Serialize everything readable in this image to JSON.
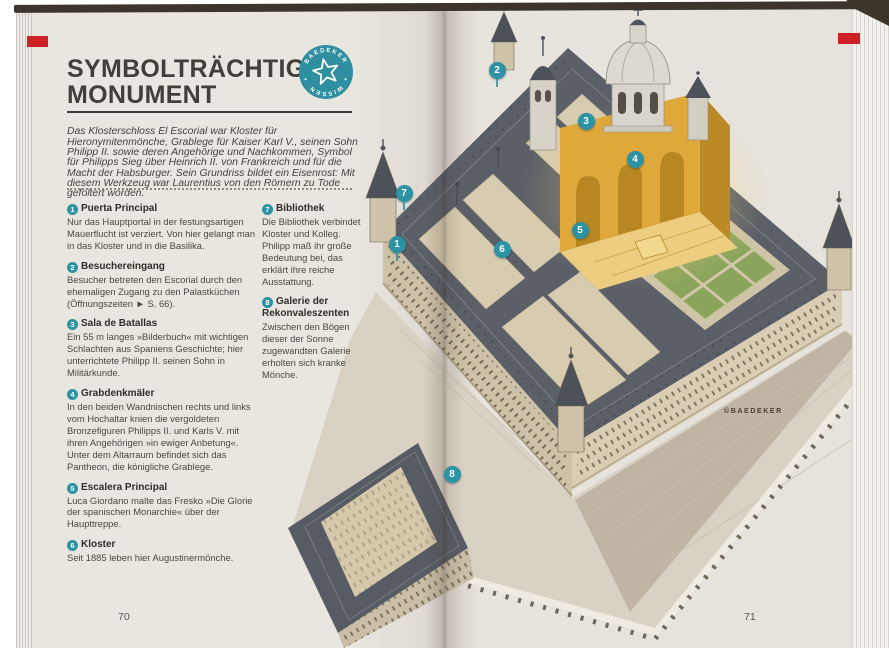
{
  "book": {
    "title_line1": "SYMBOLTRÄCHTIGES",
    "title_line2": "MONUMENT",
    "badge": {
      "top": "BAEDEKER",
      "bottom": "WISSEN",
      "color": "#2e8fa0"
    },
    "intro": "Das Klosterschloss El Escorial war Kloster für Hieronymitenmönche, Grablege für Kaiser Karl V., seinen Sohn Philipp II. sowie deren Angehörige und Nachkommen, Symbol für Philipps Sieg über Heinrich II. von Frankreich und für die Macht der Habsburger. Sein Grundriss bildet ein Eisenrost: Mit diesem Werkzeug war Laurentius von den Römern zu Tode gefoltert worden.",
    "credit": "©BAEDEKER",
    "left_page_number": "70",
    "right_page_number": "71"
  },
  "legend": {
    "items": [
      {
        "num": "1",
        "title": "Puerta Principal",
        "text": "Nur das Hauptportal in der festungsartigen Mauerflucht ist verziert. Von hier gelangt man in das Kloster und in die Basilika."
      },
      {
        "num": "2",
        "title": "Besuchereingang",
        "text": "Besucher betreten den Escorial durch den ehemaligen Zugang zu den Palastküchen (Öffnungszeiten ► S. 66)."
      },
      {
        "num": "3",
        "title": "Sala de Batallas",
        "text": "Ein 55 m langes »Bilderbuch« mit wichtigen Schlachten aus Spaniens Geschichte; hier unterrichtete Philipp II. seinen Sohn in Militärkunde."
      },
      {
        "num": "4",
        "title": "Grabdenkmäler",
        "text": "In den beiden Wandnischen rechts und links vom Hochaltar knien die vergoldeten Bronzefiguren Philipps II. und Karls V. mit ihren Angehörigen »in ewiger Anbetung«. Unter dem Altarraum befindet sich das Pantheon, die königliche Grablege."
      },
      {
        "num": "5",
        "title": "Escalera Principal",
        "text": "Luca Giordano malte das Fresko »Die Glorie der spanischen Monarchie« über der Haupttreppe."
      },
      {
        "num": "6",
        "title": "Kloster",
        "text": "Seit 1885 leben hier Augustinermönche."
      },
      {
        "num": "7",
        "title": "Bibliothek",
        "text": "Die Bibliothek verbindet Kloster und Kolleg. Philipp maß ihr große Bedeutung bei, das erklärt ihre reiche Ausstattung."
      },
      {
        "num": "8",
        "title": "Galerie der Rekonvaleszenten",
        "text": "Zwischen den Bögen dieser der Sonne zugewandten Galerie erholten sich kranke Mönche."
      }
    ]
  },
  "diagram": {
    "subject": "El Escorial aerial cutaway illustration",
    "markers": [
      {
        "n": "1"
      },
      {
        "n": "2"
      },
      {
        "n": "3"
      },
      {
        "n": "4"
      },
      {
        "n": "5"
      },
      {
        "n": "6"
      },
      {
        "n": "7"
      },
      {
        "n": "8"
      }
    ],
    "colors": {
      "accent_teal": "#2b93a4",
      "bookmark_red": "#ce2127",
      "gold_cutaway": "#dfa83a",
      "roof_gray": "#5a5f68",
      "wall_beige": "#cfc3aa",
      "garden_green": "#8aa45c"
    }
  }
}
